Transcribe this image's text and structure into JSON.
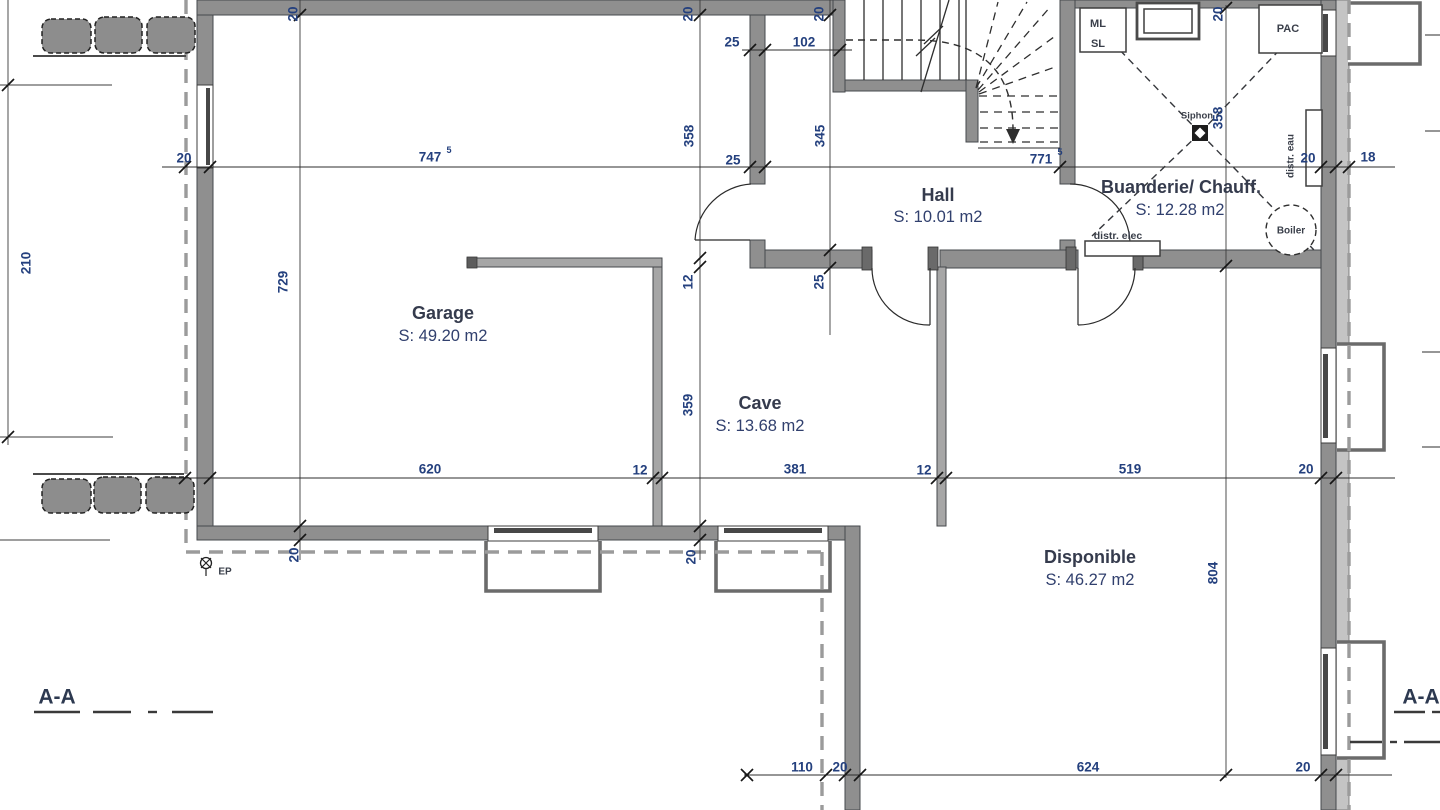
{
  "rooms": {
    "garage": {
      "name": "Garage",
      "area": "S: 49.20 m2"
    },
    "cave": {
      "name": "Cave",
      "area": "S: 13.68 m2"
    },
    "hall": {
      "name": "Hall",
      "area": "S: 10.01 m2"
    },
    "buanderie": {
      "name": "Buanderie/ Chauff.",
      "area": "S: 12.28 m2"
    },
    "disponible": {
      "name": "Disponible",
      "area": "S: 46.27 m2"
    }
  },
  "labels": {
    "ml": "ML",
    "sl": "SL",
    "pac": "PAC",
    "siphon": "Siphon",
    "boiler": "Boiler",
    "distr_eau": "distr. eau",
    "distr_elec": "distr. elec",
    "ep": "EP"
  },
  "sections": {
    "left": "A-A",
    "right": "A-A"
  },
  "dims": {
    "d20_tl": "20",
    "d20_tm": "20",
    "d20_th": "20",
    "d20_tr": "20",
    "d25_u": "25",
    "d102": "102",
    "d358_g": "358",
    "d345": "345",
    "d20_l": "20",
    "d747": "747",
    "d747_sup": "5",
    "d25_l": "25",
    "d771": "771",
    "d771_sup": "5",
    "d20_wr": "20",
    "d18": "18",
    "d210": "210",
    "d729": "729",
    "d12_ct": "12",
    "d25_hw": "25",
    "d358_b": "358",
    "d359": "359",
    "d620": "620",
    "d12_a": "12",
    "d381": "381",
    "d12_b": "12",
    "d519": "519",
    "d20_rm": "20",
    "d20_ba": "20",
    "d20_bb": "20",
    "d804": "804",
    "d110": "110",
    "d20_bc": "20",
    "d624": "624",
    "d20_bd": "20"
  },
  "colors": {
    "dim_text": "#24407e",
    "room_text": "#353b4d",
    "wall": "#8f8f8f",
    "wall_light": "#a6a6a6",
    "insulation": "#c4c4c4",
    "line": "#2d2d2d",
    "boundary": "#9b9b9b"
  }
}
